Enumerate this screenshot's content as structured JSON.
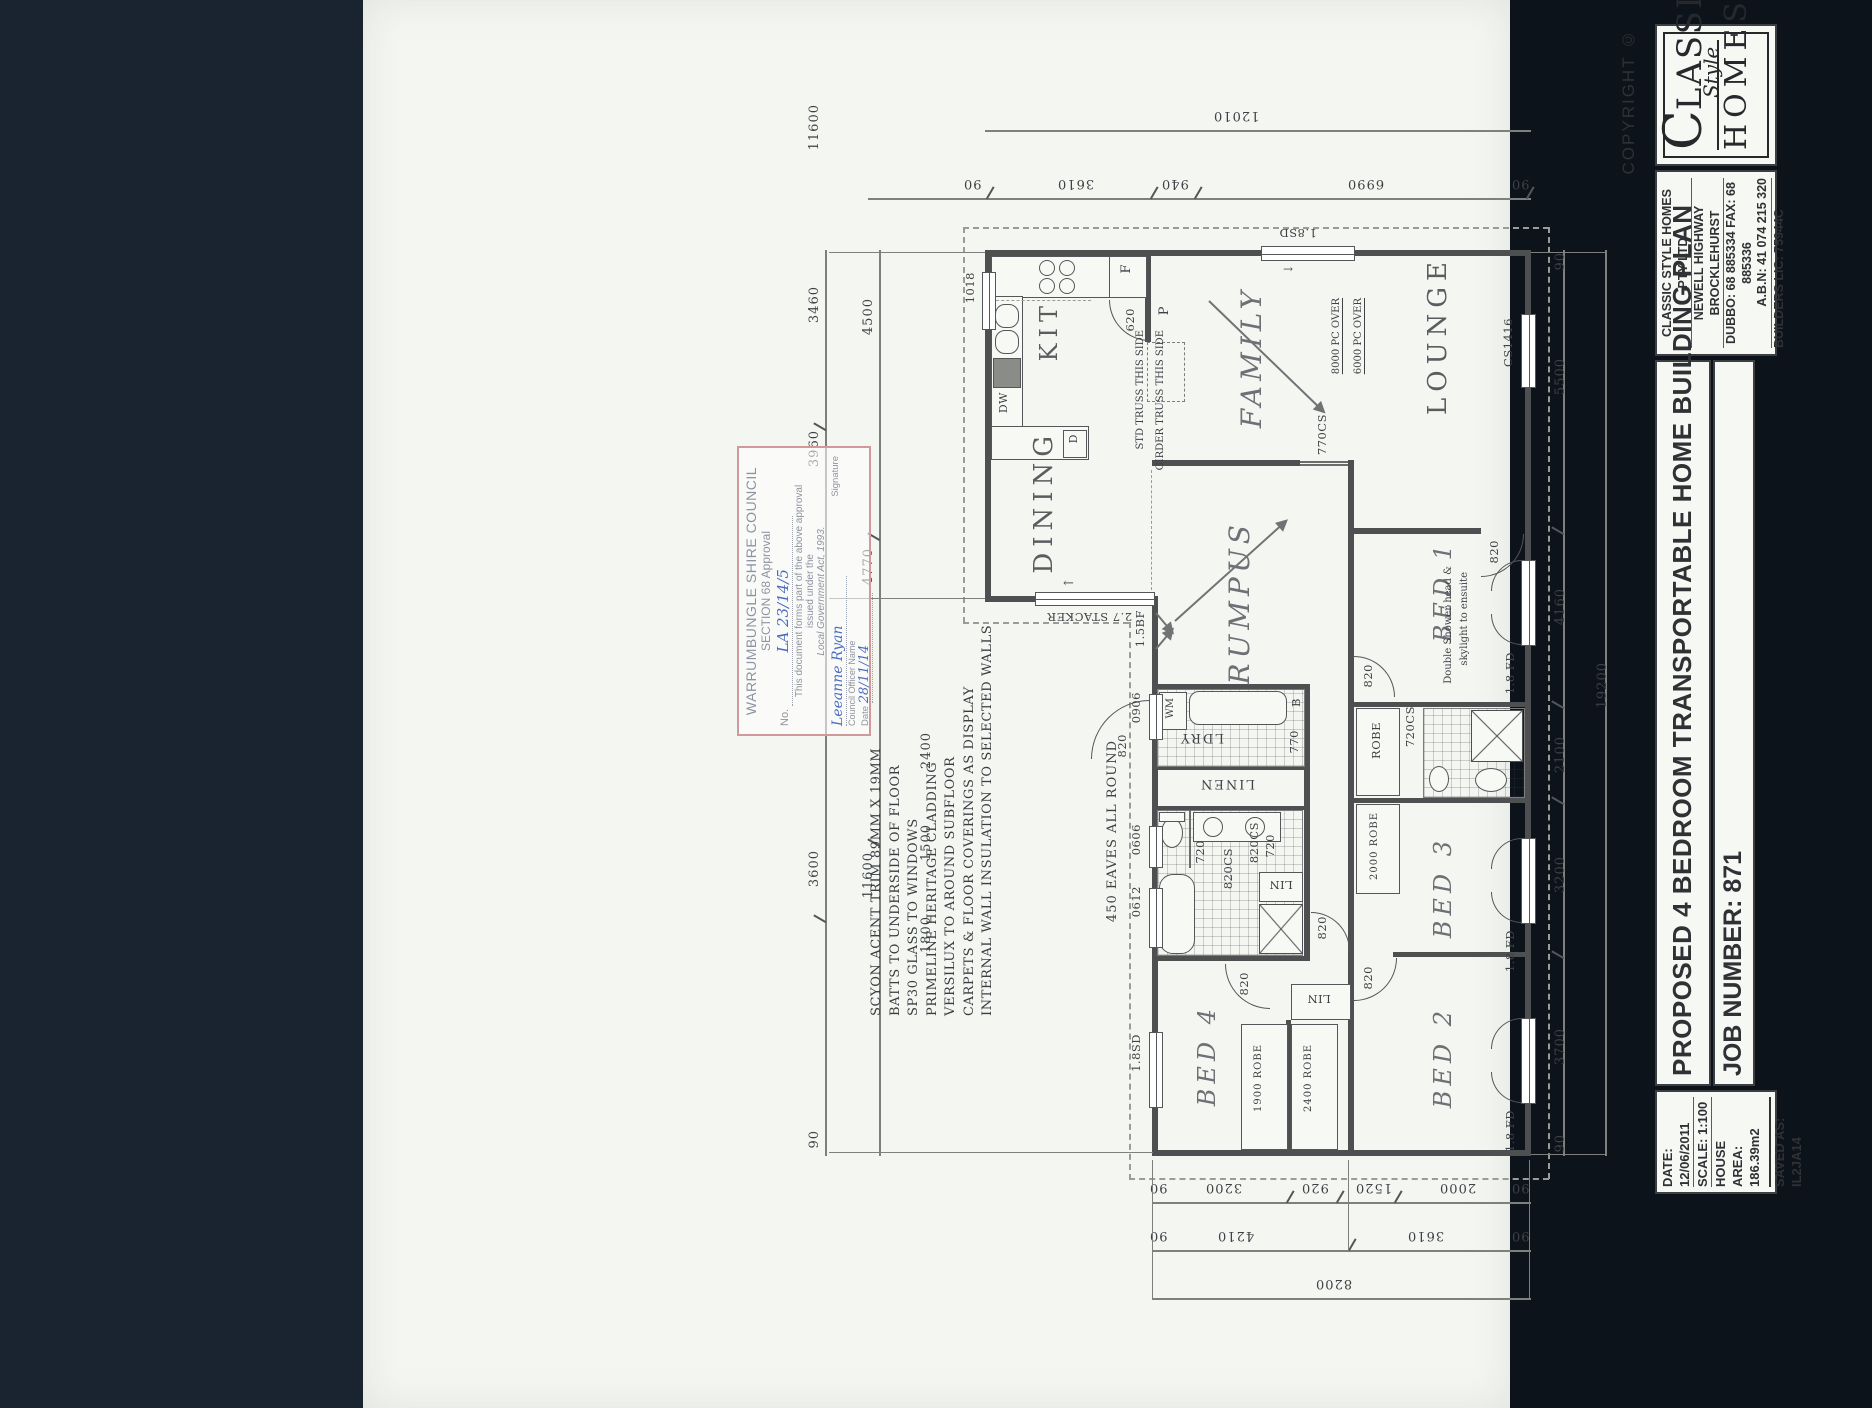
{
  "title_block": {
    "copyright": "COPYRIGHT ©",
    "logo_lassic": "LASSIC",
    "logo_style": "Style",
    "logo_homes": "HOMES",
    "company_lines": [
      "CLASSIC STYLE HOMES PTY LTD",
      "NEWELL HIGHWAY BROCKLEHURST",
      "DUBBO: 68 885334 FAX: 68 885336",
      "A.B.N: 41 074 215 320",
      "BUILDERS LIC: 75944C"
    ],
    "plan_title": "PROPOSED 4 BEDROOM TRANSPORTABLE HOME BUILDING PLAN",
    "job_number": "JOB NUMBER: 871",
    "detail_lines": [
      "DATE: 12/06/2011",
      "SCALE: 1:100",
      "HOUSE AREA: 186.39m2",
      "SAVED AS: IL2JA14"
    ]
  },
  "stamp": {
    "council": "WARRUMBUNGLE SHIRE COUNCIL",
    "section": "SECTION 68 Approval",
    "no_label": "No.",
    "no_value": "LA 23/14/5",
    "body1": "This document forms part of the above approval",
    "body2": "issued under the",
    "body3": "Local Government Act, 1993.",
    "officer_name": "Leeanne Ryan",
    "officer_label": "Council Officer Name",
    "signature_label": "Signature",
    "date_label": "Date",
    "date_value": "28/11/14"
  },
  "notes": [
    "SCYON ACENT TRIM 89MM X 19MM",
    "BATTS TO UNDERSIDE OF FLOOR",
    "SP30 GLASS TO WINDOWS",
    "PRIMELINE HERITAGE CLADDING",
    "VERSILUX TO AROUND SUBFLOOR",
    "CARPETS & FLOOR COVERINGS AS DISPLAY",
    "INTERNAL WALL INSULATION TO SELECTED WALLS"
  ],
  "eaves_note": "450 EAVES ALL ROUND",
  "rooms": {
    "kitchen": "KIT",
    "dining": "DINING",
    "family": "FAMILY",
    "lounge": "LOUNGE",
    "rumpus": "RUMPUS",
    "bed1": "BED 1",
    "bed2": "BED 2",
    "bed3": "BED 3",
    "bed4": "BED 4",
    "laundry": "LDRY",
    "linen": "LINEN"
  },
  "fixtures": {
    "wm": "WM",
    "bath_tub": "B",
    "dw": "DW",
    "d": "D",
    "fridge": "F",
    "pantry": "P",
    "lin": "LIN",
    "robe": "ROBE",
    "robe_1900": "1900 ROBE",
    "robe_2400": "2400 ROBE",
    "robe_2000": "2000 ROBE"
  },
  "annotations": {
    "truss_std": "STD TRUSS THIS SIDE",
    "truss_girder": "GIRDER TRUSS THIS SIDE",
    "pc_8000": "8000 PC OVER",
    "pc_6000": "6000 PC OVER",
    "ensuite_note_1": "Double Shower head &",
    "ensuite_note_2": "skylight to ensuite"
  },
  "codes": {
    "sd18": "1.8SD",
    "cs1416": "CS1416",
    "cs770": "770CS",
    "cs720": "720CS",
    "d820": "820",
    "d770": "770",
    "d720": "720",
    "cs820": "820CS",
    "w0906": "0906",
    "w0606": "0606",
    "w0612": "0612",
    "w1018": "1018",
    "fd18": "1.8 FD",
    "bf15": "1.5BF",
    "stacker": "2.7 STACKER",
    "d620": "620"
  },
  "dims": {
    "top_overall": "12010",
    "top_row": [
      "90",
      "3610",
      "940",
      "6990",
      "90"
    ],
    "left_outer": [
      "11600",
      "3460",
      "3960",
      "3600",
      "90"
    ],
    "left_inner": [
      "4500",
      "4770",
      "11600"
    ],
    "left_inner2": [
      "2400",
      "1500",
      "1800"
    ],
    "right": [
      "90",
      "5500",
      "4160",
      "2100",
      "3200",
      "3700",
      "90"
    ],
    "right_overall": "19200",
    "bottom_row1": [
      "90",
      "3200",
      "920",
      "1520",
      "2000",
      "90"
    ],
    "bottom_row2": [
      "90",
      "4210",
      "3610",
      "90"
    ],
    "bottom_overall": "8200"
  }
}
